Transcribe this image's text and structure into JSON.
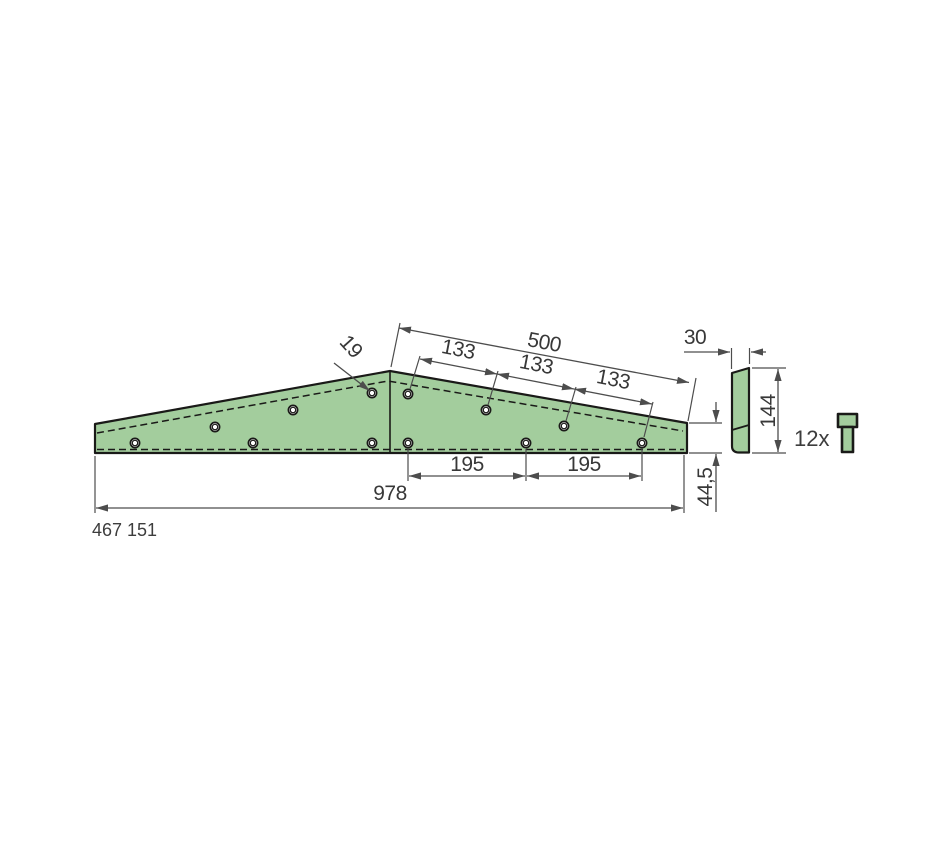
{
  "part": {
    "number": "467 151",
    "fastener_quantity": "12x",
    "hole_count": 12
  },
  "dimensions": {
    "overall_length": "978",
    "right_section_length": "500",
    "top_hole_spacing": "133",
    "bottom_hole_spacing": "195",
    "hole_diameter": "19",
    "thickness": "30",
    "side_height": "144",
    "tip_height": "44,5"
  },
  "colors": {
    "part_fill": "#a3cd9d",
    "part_outline": "#1a1a18",
    "dimension_line": "#4d4d4d",
    "dimension_text": "#383838"
  }
}
